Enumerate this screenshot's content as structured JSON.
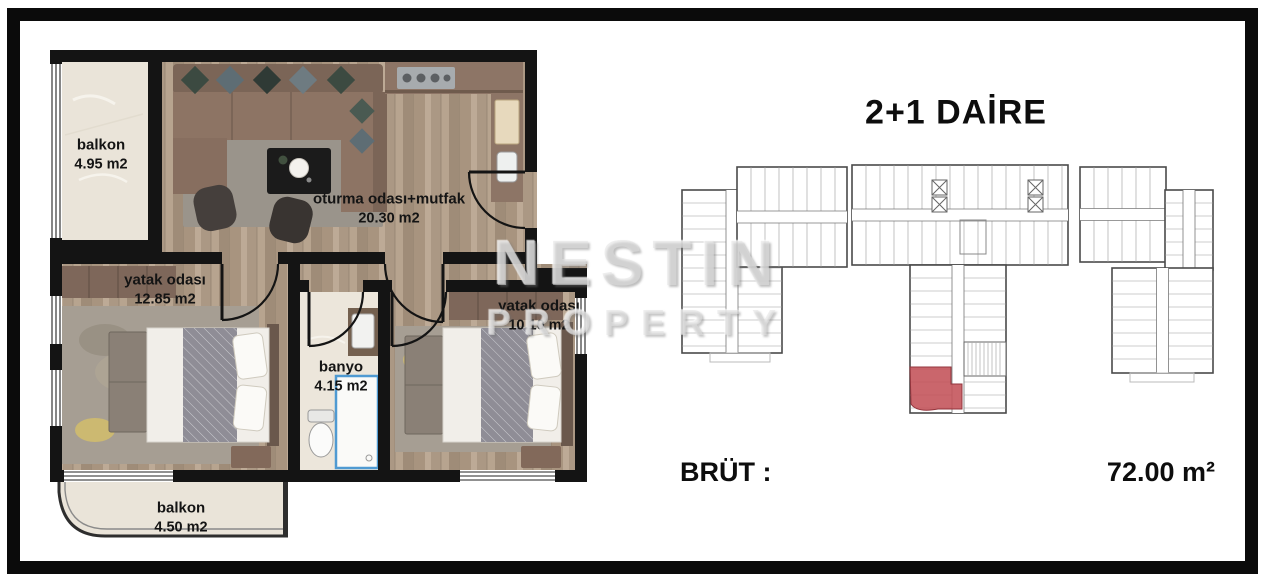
{
  "floor_plan": {
    "rooms": [
      {
        "id": "balkon-top",
        "name": "balkon",
        "area": "4.95 m2"
      },
      {
        "id": "living-kitchen",
        "name": "oturma odası+mutfak",
        "area": "20.30 m2"
      },
      {
        "id": "bedroom-1",
        "name": "yatak odası",
        "area": "12.85 m2"
      },
      {
        "id": "bathroom",
        "name": "banyo",
        "area": "4.15 m2"
      },
      {
        "id": "bedroom-2",
        "name": "yatak odası",
        "area": "10.10 m2"
      },
      {
        "id": "balkon-bottom",
        "name": "balkon",
        "area": "4.50 m2"
      }
    ]
  },
  "panel": {
    "title": "2+1 DAİRE",
    "brut_label": "BRÜT :",
    "brut_value": "72.00 m²"
  },
  "watermark": {
    "line1": "NESTIN",
    "line2": "PROPERTY"
  },
  "colors": {
    "highlight_unit": "#c35158",
    "walls": "#141414"
  }
}
